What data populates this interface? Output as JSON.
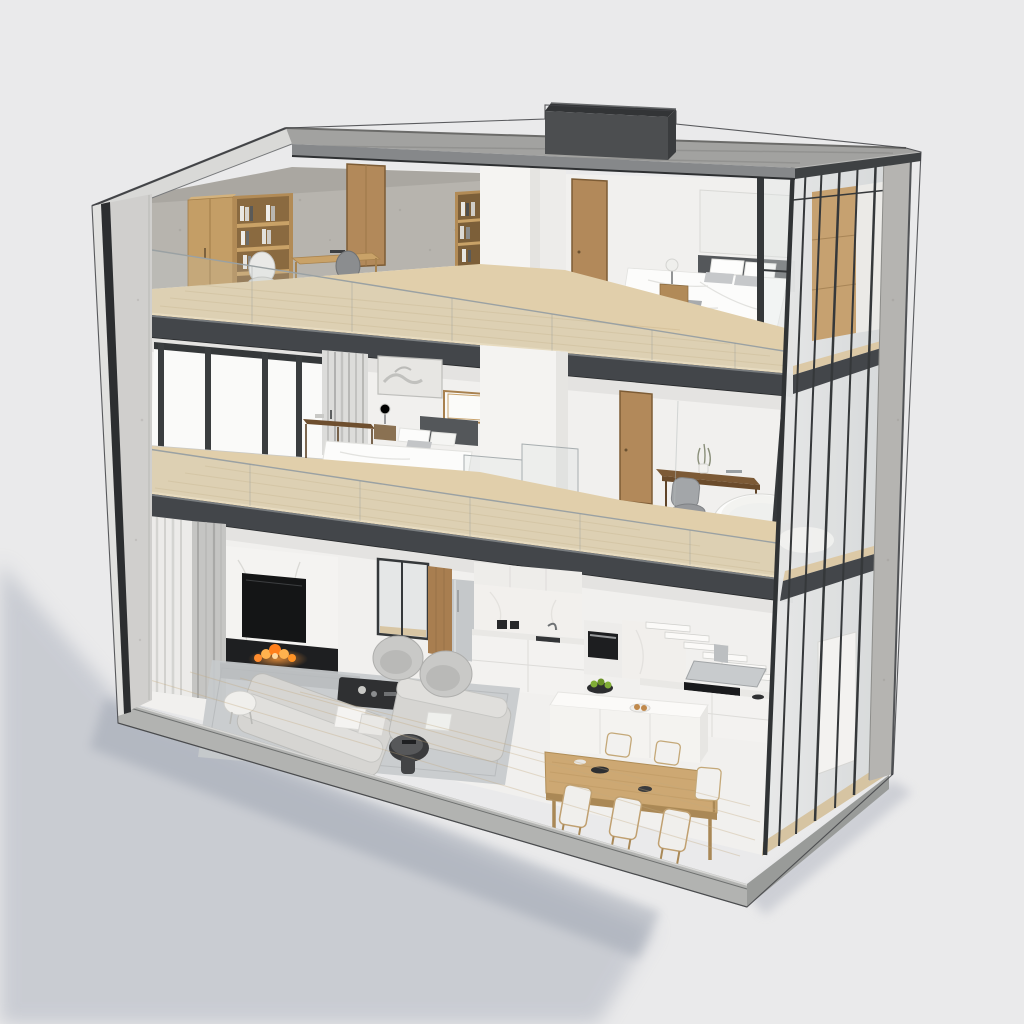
{
  "canvas": {
    "width": 1024,
    "height": 1024
  },
  "scene": {
    "type": "architectural-cutaway-3d-render",
    "view": "dollhouse-section-perspective",
    "building": {
      "floors_visible": 3,
      "roof": "flat-concrete-slab-with-dark-chimney",
      "left_wall": "sectioned-concrete-wall",
      "right_facade": "glass-curtain-wall-with-dark-mullions",
      "base": "concrete-plinth"
    },
    "floors": [
      {
        "id": "top",
        "label": "Top floor",
        "rooms": [
          {
            "name": "home-office",
            "items": [
              "wood-cabinet",
              "open-bookshelf",
              "books",
              "writing-desk",
              "white-office-chair",
              "dark-side-chair",
              "tall-bookshelf",
              "interior-wood-door",
              "concrete-back-wall"
            ]
          },
          {
            "name": "bedroom",
            "items": [
              "double-bed",
              "white-duvet",
              "gray-throw",
              "pillows",
              "dark-headboard",
              "nightstand",
              "table-lamp",
              "wall-panel",
              "interior-wood-door",
              "corner-glazing",
              "wood-wardrobe"
            ]
          }
        ]
      },
      {
        "id": "middle",
        "label": "Middle floor",
        "rooms": [
          {
            "name": "master-bedroom",
            "items": [
              "window-wall",
              "gray-curtain",
              "framed-artwork",
              "small-wood-window",
              "console-table",
              "nightstand",
              "table-lamp",
              "double-bed",
              "gray-blanket",
              "pillows",
              "area-rug",
              "pendant-light"
            ]
          },
          {
            "name": "landing",
            "items": [
              "wood-tread-staircase",
              "glass-balustrade",
              "white-core-wall",
              "interior-wood-door"
            ]
          },
          {
            "name": "study-bathroom",
            "items": [
              "desk",
              "office-chair",
              "potted-plant",
              "freestanding-oval-bathtub"
            ]
          }
        ]
      },
      {
        "id": "ground",
        "label": "Ground floor",
        "rooms": [
          {
            "name": "living-room",
            "items": [
              "floor-to-ceiling-curtains",
              "marble-fireplace-wall",
              "wall-mounted-tv",
              "linear-fireplace-flames",
              "dark-hearth-bench",
              "large-area-rug",
              "fabric-sofa",
              "fabric-sofa",
              "barrel-armchair",
              "barrel-armchair",
              "dark-coffee-table",
              "white-round-side-table",
              "black-round-side-table",
              "sliding-glass-door",
              "wood-wall-panel"
            ]
          },
          {
            "name": "kitchen",
            "items": [
              "stainless-fridge",
              "upper-cabinets",
              "marble-backsplash",
              "sink",
              "faucet",
              "coffee-machines",
              "wall-oven",
              "base-cabinets",
              "floating-white-stairs",
              "stainless-range-hood",
              "black-cooktop",
              "white-kitchen-island",
              "dark-fruit-bowl",
              "green-apples",
              "serving-plate"
            ]
          },
          {
            "name": "dining-area",
            "items": [
              "wood-dining-table",
              "dining-chair",
              "dining-chair",
              "dining-chair",
              "dining-chair",
              "dining-chair",
              "dining-chair",
              "dark-tableware"
            ]
          }
        ]
      }
    ],
    "exterior_items": [
      "ground-shadow",
      "roof-beams",
      "roof-chimney",
      "glass-section-railings",
      "concrete-corner-column",
      "right-glass-facade"
    ]
  },
  "palette": {
    "background": "#eaeaeb",
    "shadow": "#a9afbb",
    "roof_gray": "#a2a2a0",
    "concrete_wall": "#b7b4ae",
    "concrete_light": "#d0cfcd",
    "slab_dark": "#43464a",
    "edge_dark": "#2c2e30",
    "wood_floor": "#e1cfab",
    "wood_furniture": "#c49e66",
    "wood_door": "#b2895a",
    "white_wall": "#f1f0ee",
    "mullion": "#35383a",
    "glass_tint": "#cfd9da",
    "sofa_gray": "#d6d5d2",
    "rug_gray": "#c7cacc",
    "tv_black": "#141516",
    "fire_orange": "#ff8c2e",
    "bed_white": "#fcfcfb",
    "blanket_gray": "#9da0a3",
    "headboard_dark": "#54575a",
    "tub_white": "#fcfcfb",
    "island_white": "#f4f3f0",
    "dining_wood": "#cda873",
    "curtain_light": "#ecebe9",
    "curtain_gray": "#c5c5c3",
    "plinth": "#b2b3b1",
    "chimney_dark": "#4c4e50",
    "apple_green": "#80ad36"
  }
}
